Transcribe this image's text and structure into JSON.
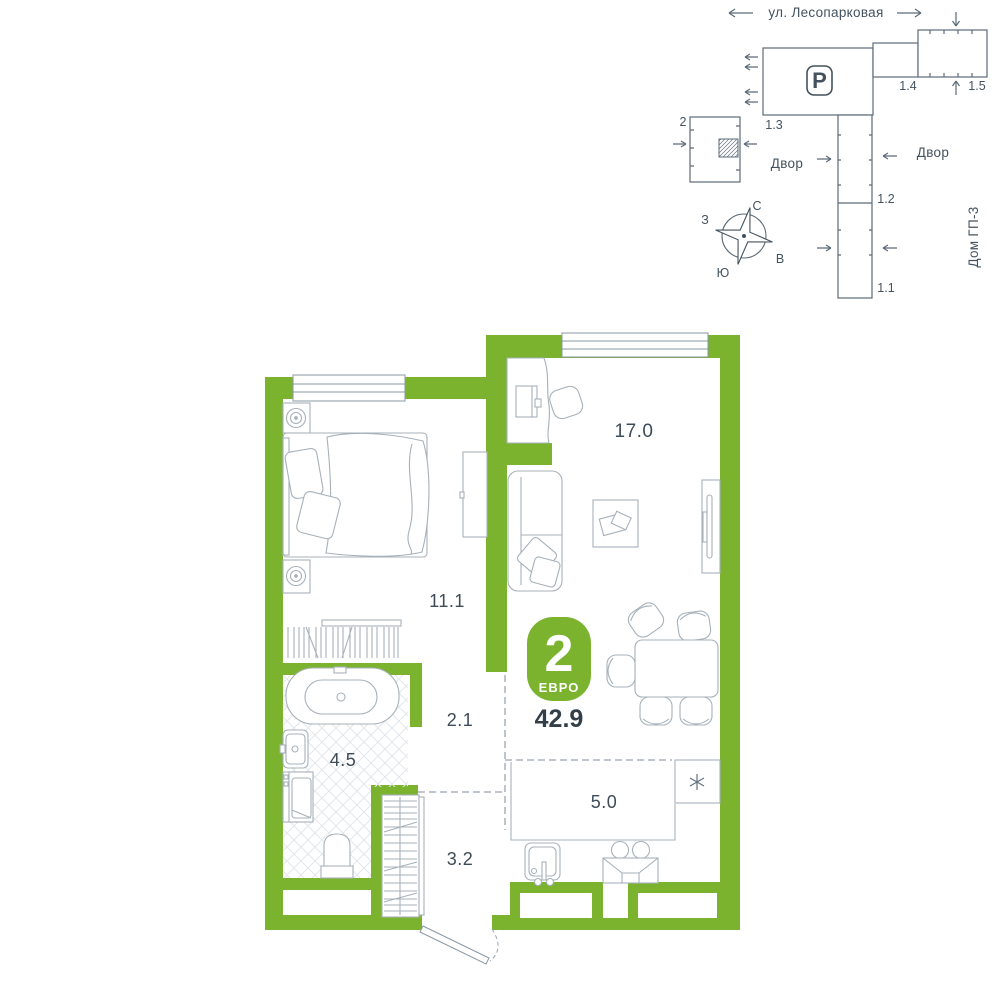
{
  "site_plan": {
    "street_label": "ул. Лесопарковая",
    "yard_label_left": "Двор",
    "yard_label_right": "Двор",
    "house_label": "Дом ГП-3",
    "parking_letter": "P",
    "buildings": {
      "b2": "2",
      "b13": "1.3",
      "b14": "1.4",
      "b15": "1.5",
      "b12": "1.2",
      "b11": "1.1"
    },
    "compass": {
      "n": "С",
      "s": "Ю",
      "w": "З",
      "e": "В"
    }
  },
  "apartment": {
    "badge": {
      "rooms_count": "2",
      "layout_type": "ЕВРО",
      "total_area": "42.9"
    },
    "areas": {
      "living": "17.0",
      "bedroom": "11.1",
      "hall": "2.1",
      "bathroom": "4.5",
      "entry": "3.2",
      "kitchen": "5.0"
    }
  },
  "colors": {
    "wall_green": "#7BB32E",
    "furniture_line": "#A6B1BA",
    "site_line": "#5C6B79",
    "text_dark": "#3D4C58"
  }
}
